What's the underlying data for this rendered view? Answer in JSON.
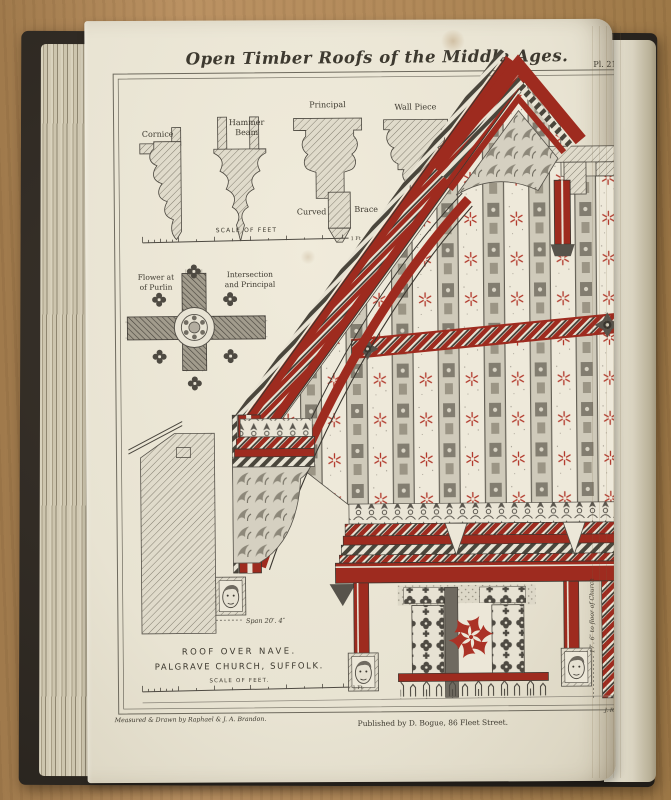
{
  "photo": {
    "surface": "wooden-table",
    "colors": {
      "wood": "#b28a5a",
      "book_cover": "#2f2a23",
      "page": "#ebe6d7",
      "page_edges": "#c9c1ab",
      "accent_red": "#9e2b1f",
      "ink": "#3d392f"
    }
  },
  "plate": {
    "number": "Pl. 21.",
    "title": "Open Timber Roofs of the Middle Ages.",
    "mouldings": {
      "cornice": "Cornice",
      "hammer_line1": "Hammer",
      "hammer_line2": "Beam",
      "principal": "Principal",
      "wall_piece": "Wall Piece",
      "curved": "Curved",
      "brace": "Brace",
      "scale_label": "SCALE OF FEET",
      "scale_end": "1 Ft"
    },
    "purlin_detail": {
      "left_line1": "Flower at",
      "left_line2": "of Purlin",
      "right_line1": "Intersection",
      "right_line2": "and Principal"
    },
    "annotations": {
      "span": "Span 20′. 4″",
      "height_to_floor": "17′. 6″ to floor of Church"
    },
    "caption": {
      "line1": "ROOF OVER NAVE.",
      "line2": "PALGRAVE CHURCH, SUFFOLK.",
      "scale_label": "SCALE OF FEET.",
      "scale_end": "1 Ft"
    },
    "credits": {
      "left": "Measured & Drawn by Raphael & J. A. Brandon.",
      "center": "Published by D. Bogue, 86 Fleet Street.",
      "right": "J. R. Jobbins, lith."
    }
  }
}
